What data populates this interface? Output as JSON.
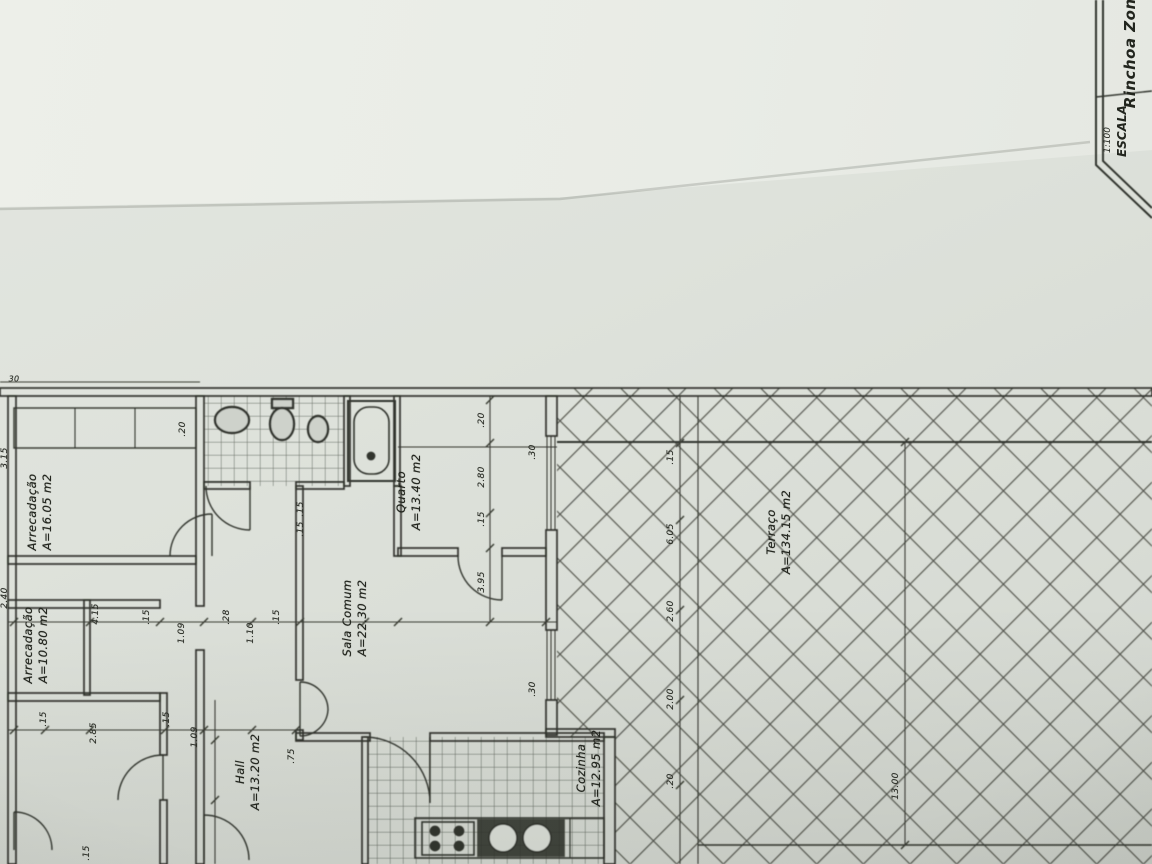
{
  "title_block": {
    "project": "Rinchoa Zona",
    "scale_label": "ESCALA",
    "scale_value": "1:100"
  },
  "rooms": [
    {
      "name": "Arrecadação",
      "area": "A=16.05 m2"
    },
    {
      "name": "Arrecadação",
      "area": "A=10.80 m2"
    },
    {
      "name": "Hall",
      "area": "A=13.20 m2"
    },
    {
      "name": "Quarto",
      "area": "A=13.40 m2"
    },
    {
      "name": "Sala Comum",
      "area": "A=22.30 m2"
    },
    {
      "name": "Cozinha",
      "area": "A=12.95 m2"
    },
    {
      "name": "Terraço",
      "area": "A=134.15 m2"
    }
  ],
  "dims": [
    {
      "text": ".20"
    },
    {
      "text": "3.15"
    },
    {
      "text": "2.40"
    },
    {
      "text": "4.15"
    },
    {
      "text": ".15"
    },
    {
      "text": "1.09"
    },
    {
      "text": "1.10"
    },
    {
      "text": ".28"
    },
    {
      "text": ".15"
    },
    {
      "text": ".15"
    },
    {
      "text": "2.85"
    },
    {
      "text": ".15"
    },
    {
      "text": "1.09"
    },
    {
      "text": ".15"
    },
    {
      "text": ".20"
    },
    {
      "text": "2.80"
    },
    {
      "text": ".15"
    },
    {
      "text": "3.95"
    },
    {
      "text": ".30"
    },
    {
      "text": ".30"
    },
    {
      "text": ".15"
    },
    {
      "text": ".15"
    },
    {
      "text": ".15"
    },
    {
      "text": "6.05"
    },
    {
      "text": "2.60"
    },
    {
      "text": "2.00"
    },
    {
      "text": ".20"
    },
    {
      "text": "13.00"
    },
    {
      "text": "30"
    },
    {
      "text": ".75"
    }
  ],
  "colors": {
    "paper": "#dde1da",
    "paper_bright": "#eceee9",
    "ink": "#32352e",
    "hatch": "#383b33"
  },
  "icons": {
    "fixtures": [
      "washbasin",
      "toilet",
      "bidet",
      "bathtub",
      "stove",
      "double-sink"
    ]
  }
}
